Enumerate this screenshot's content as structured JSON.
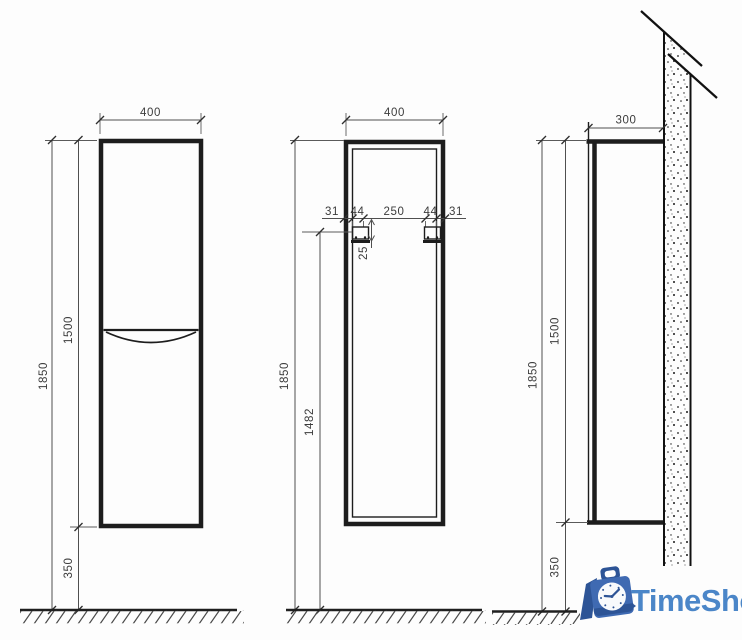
{
  "drawing": {
    "front_view": {
      "width": "400",
      "height": "1500",
      "total_height": "1850",
      "floor_clearance": "350"
    },
    "back_view": {
      "width": "400",
      "mount_spacing": [
        "31",
        "44",
        "250",
        "44",
        "31"
      ],
      "bracket_drop": "25",
      "mount_height": "1482",
      "total_height": "1850"
    },
    "side_view": {
      "depth": "300",
      "height": "1500",
      "total_height": "1850",
      "floor_clearance": "350"
    }
  },
  "logo": {
    "text": "TimeShop",
    "text_color": "#4b86c8",
    "icon_main_color": "#3f6ab2",
    "icon_dark_color": "#2d5496",
    "icon_face_color": "#f8fafc"
  },
  "colors": {
    "cabinet_line": "#1d1d1d",
    "dimension_line": "#4f4f4f",
    "dimension_text": "#3c3c3c",
    "background": "#fdfdfd"
  }
}
